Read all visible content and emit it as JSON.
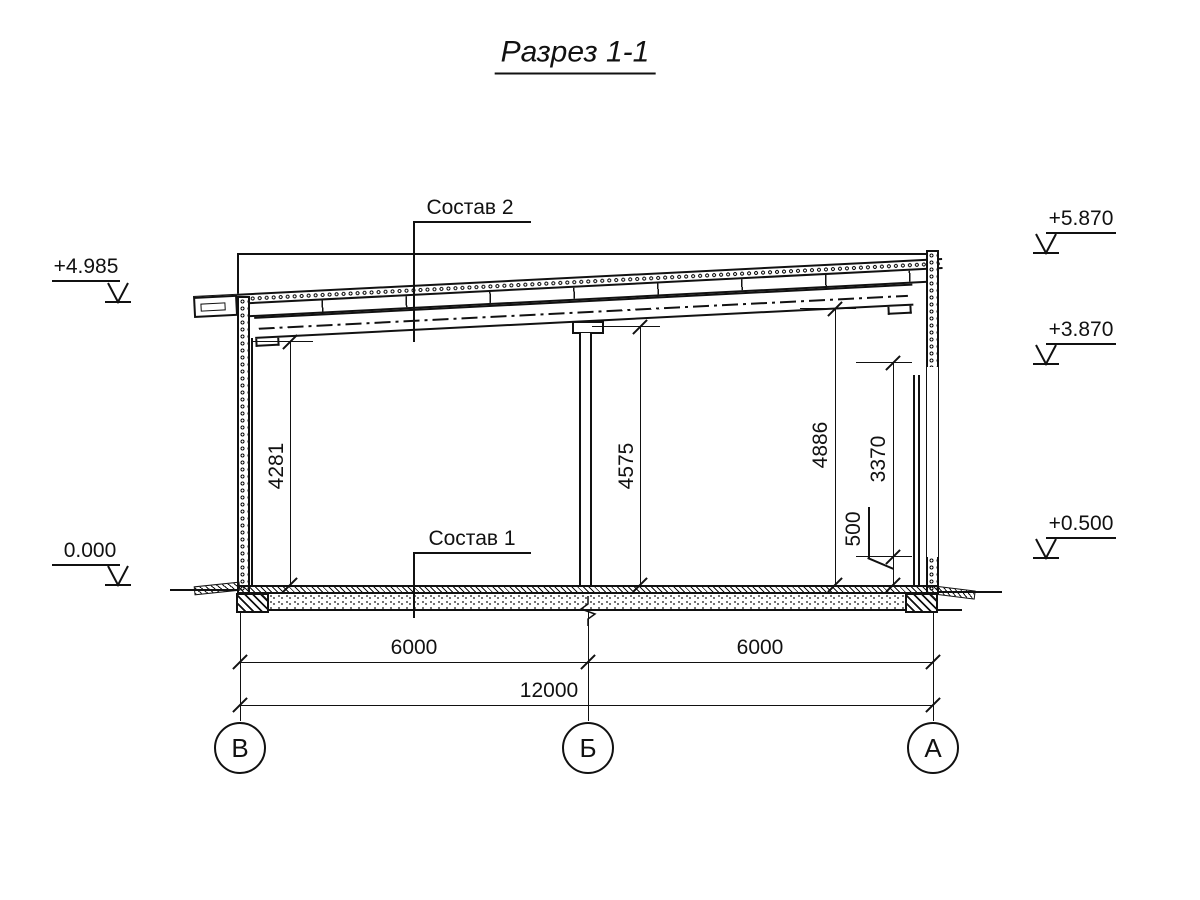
{
  "title": "Разрез 1-1",
  "callouts": {
    "roof_composition": "Состав 2",
    "floor_composition": "Состав 1"
  },
  "elevation_marks": {
    "left_top": "+4.985",
    "left_bottom": "0.000",
    "right_top": "+5.870",
    "right_middle": "+3.870",
    "right_bottom": "+0.500"
  },
  "dimensions": {
    "vertical": [
      {
        "label": "4281"
      },
      {
        "label": "4575"
      },
      {
        "label": "4886"
      },
      {
        "label": "3370"
      },
      {
        "label": "500"
      }
    ],
    "horizontal": [
      {
        "label": "6000"
      },
      {
        "label": "6000"
      },
      {
        "label": "12000"
      }
    ]
  },
  "axes": [
    {
      "label": "В"
    },
    {
      "label": "Б"
    },
    {
      "label": "А"
    }
  ],
  "colors": {
    "line": "#111111",
    "background": "#ffffff"
  }
}
